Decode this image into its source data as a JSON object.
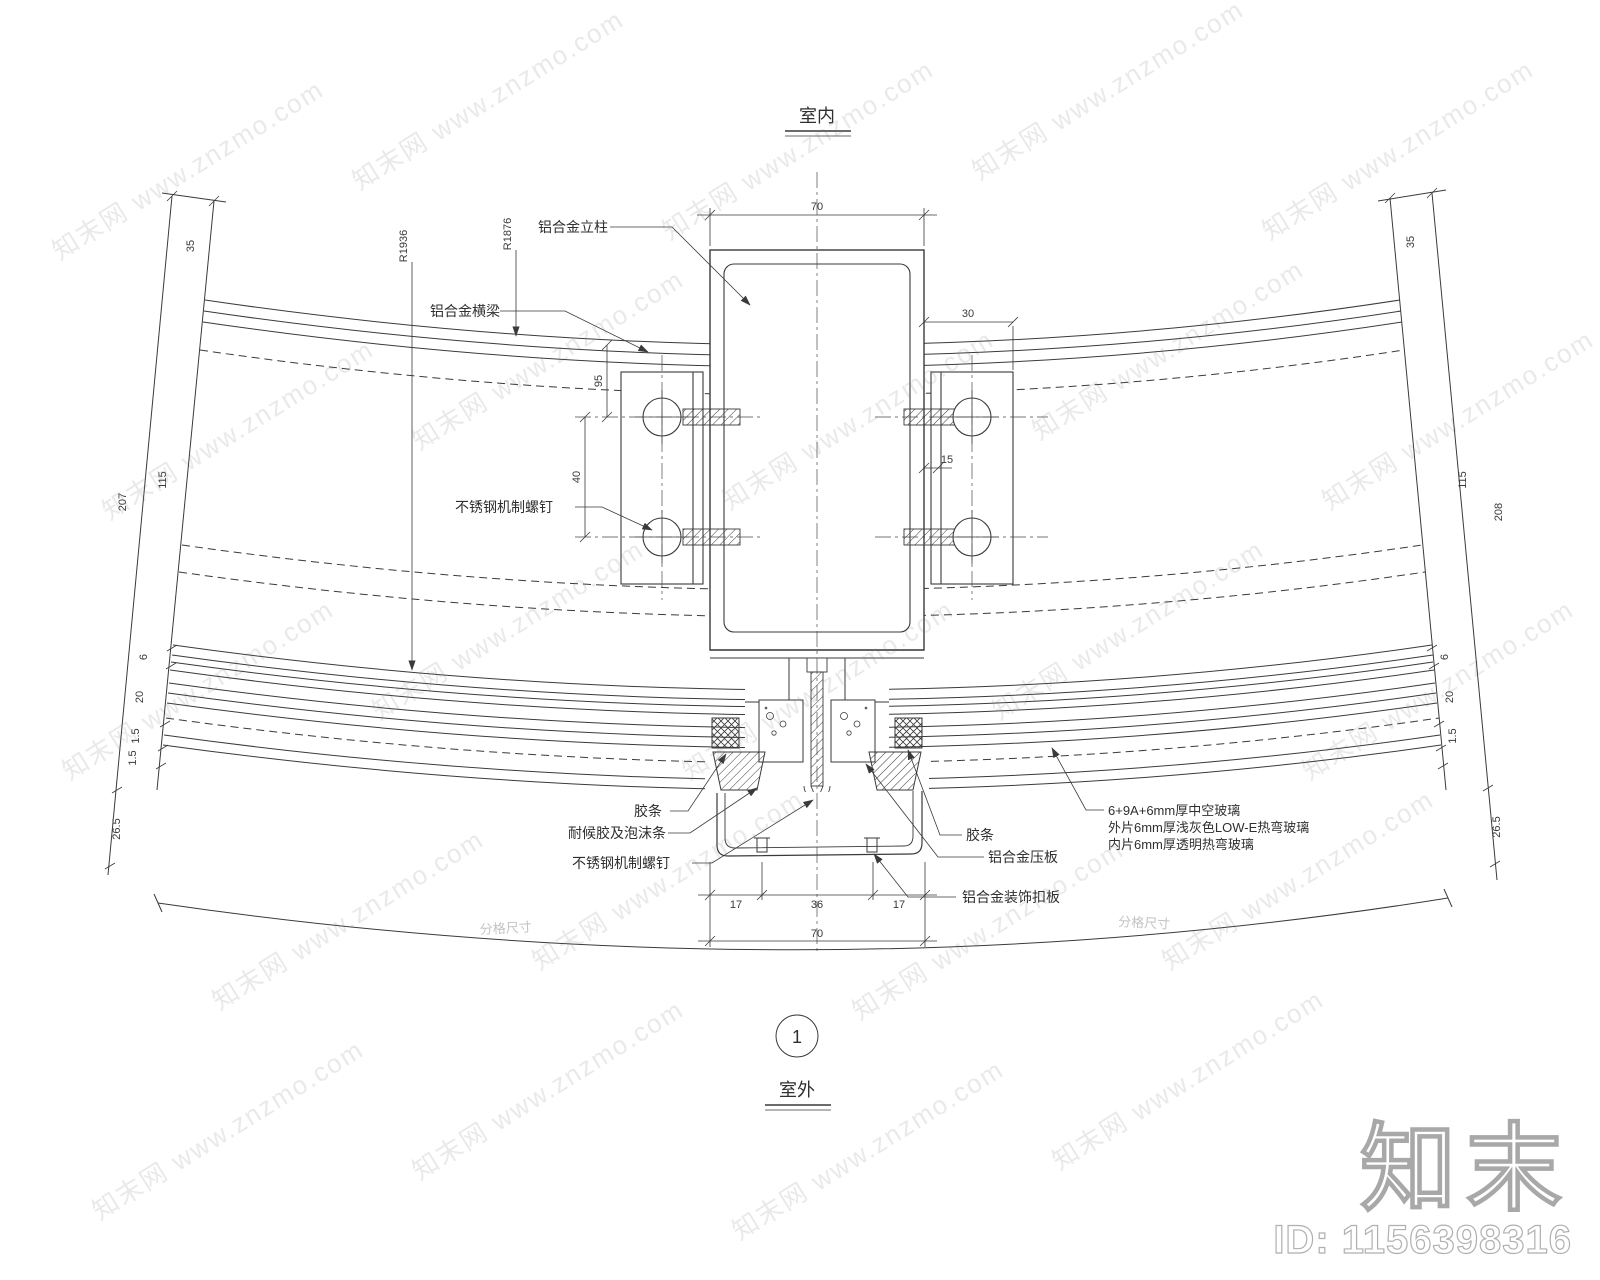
{
  "drawing": {
    "indoor_label": "室内",
    "outdoor_label": "室外",
    "section_number": "1"
  },
  "part_labels": {
    "mullion": "铝合金立柱",
    "transom": "铝合金横梁",
    "machine_screw_upper": "不锈钢机制螺钉",
    "gasket_left": "胶条",
    "weather_seal": "耐候胶及泡沫条",
    "machine_screw_lower": "不锈钢机制螺钉",
    "gasket_right": "胶条",
    "pressure_plate": "铝合金压板",
    "cover_plate": "铝合金装饰扣板"
  },
  "glass_spec": {
    "line1": "6+9A+6mm厚中空玻璃",
    "line2": "外片6mm厚浅灰色LOW-E热弯玻璃",
    "line3": "内片6mm厚透明热弯玻璃"
  },
  "radii": {
    "outer_frame": "R1876",
    "glass": "R1936"
  },
  "dimensions": {
    "mullion_width": "70",
    "bracket_offset": "30",
    "edge_gap": "15",
    "bolt_spacing": "40",
    "bracket_top": "95",
    "top_edge_left": "35",
    "top_edge_right": "35",
    "cover_left": "17",
    "cover_mid": "36",
    "cover_right": "17",
    "cover_total": "70",
    "left_chain": {
      "outer": "207",
      "inner": "115",
      "d6": "6",
      "d20": "20",
      "d15a": "1.5",
      "d15b": "1.5",
      "d265": "26.5"
    },
    "right_chain": {
      "outer": "208",
      "inner": "115",
      "d6": "6",
      "d20": "20",
      "d15": "1.5",
      "d265": "26.5"
    },
    "grid_note_left": "分格尺寸",
    "grid_note_right": "分格尺寸"
  },
  "watermark": {
    "tile": "知末网 www.znzmo.com",
    "logo": "知末",
    "id_text": "ID: 1156398316"
  }
}
